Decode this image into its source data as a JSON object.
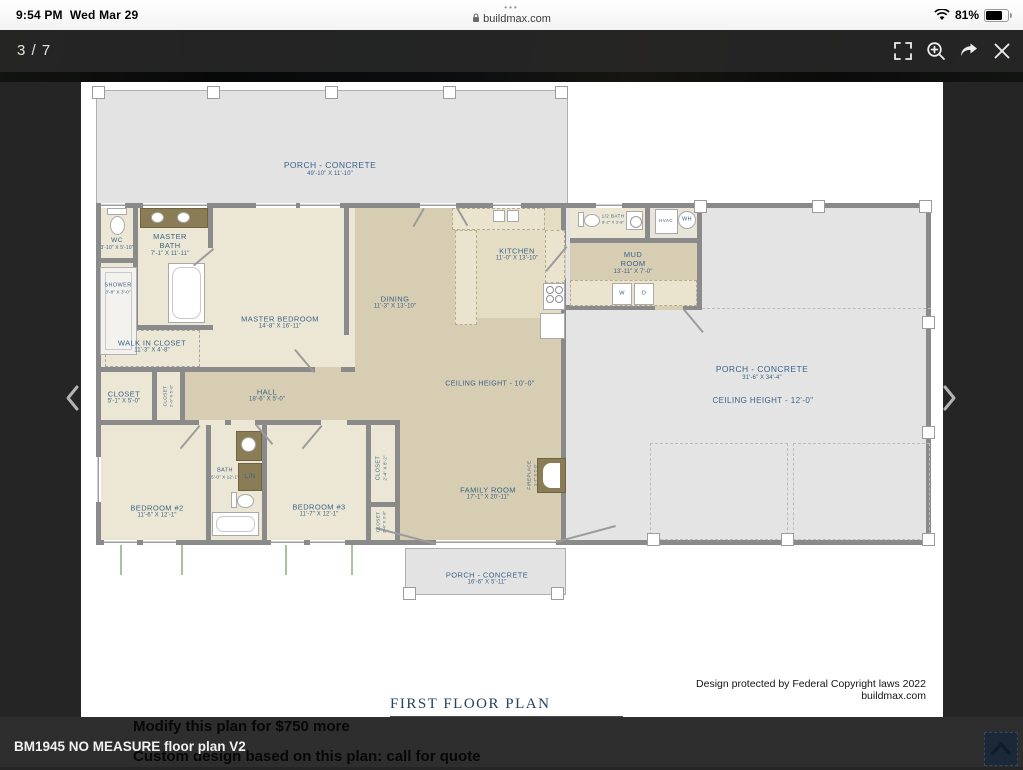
{
  "status_bar": {
    "time": "9:54 PM",
    "date": "Wed Mar 29",
    "tab_dots": "•••",
    "url": "buildmax.com",
    "battery": "81%"
  },
  "toolbar": {
    "page_indicator": "3 / 7"
  },
  "icons": {
    "lock": "padlock",
    "wifi": "wifi-arcs",
    "battery": "battery-80",
    "fullscreen": "⛶",
    "zoom_in": "magnifier-plus",
    "share": "curved-arrow",
    "close": "✕",
    "prev": "‹",
    "next": "›",
    "scroll_top": "chevron-up"
  },
  "plan": {
    "title": "FIRST FLOOR PLAN",
    "copyright": "Design protected by Federal Copyright laws 2022 buildmax.com",
    "colors": {
      "label_ink": "#3a6288",
      "floor_cream": "#ece7d4",
      "floor_khaki": "#d6cdb2",
      "wall": "#8a8a8a",
      "porch": "#e4e4e4",
      "cabinet": "#8a7c54"
    },
    "areas": [
      {
        "name": "PORCH - CONCRETE",
        "dims": "49'-10\" X 11'-10\""
      },
      {
        "name": "WC",
        "dims": "3'-10\" X 5'-10\""
      },
      {
        "name": "MASTER BATH",
        "dims": "7'-1\" X 11'-11\""
      },
      {
        "name": "SHOWER",
        "dims": "3'-8\" X 3'-0\""
      },
      {
        "name": "MASTER BEDROOM",
        "dims": "14'-8\" X 16'-11\""
      },
      {
        "name": "WALK IN CLOSET",
        "dims": "11'-3\" X 4'-8\""
      },
      {
        "name": "CLOSET",
        "dims": "5'-1\" X 5'-0\""
      },
      {
        "name": "CLOSET",
        "dims": "2'-0\" X 5'-0\""
      },
      {
        "name": "HALL",
        "dims": "18'-6\" X 5'-0\""
      },
      {
        "name": "DINING",
        "dims": "11'-3\" X 13'-10\""
      },
      {
        "name": "KITCHEN",
        "dims": "11'-0\" X 13'-10\""
      },
      {
        "name": "MUD ROOM",
        "dims": "13'-11\" X 7'-0\""
      },
      {
        "name": "1/2 BATH",
        "dims": "8'-2\" X 3'-8\""
      },
      {
        "name": "HVAC"
      },
      {
        "name": "WH"
      },
      {
        "name": "W"
      },
      {
        "name": "D"
      },
      {
        "name": "BATH",
        "dims": "5'-0\" X 12'-1\""
      },
      {
        "name": "LIN"
      },
      {
        "name": "BEDROOM #2",
        "dims": "11'-6\" X 12'-1\""
      },
      {
        "name": "BEDROOM #3",
        "dims": "11'-7\" X 12'-1\""
      },
      {
        "name": "CLOSET",
        "dims": "2'-4\" X 8'-2\""
      },
      {
        "name": "CLOSET",
        "dims": "2'-4\" X 3'-8\""
      },
      {
        "name": "FAMILY ROOM",
        "dims": "17'-1\" X 20'-11\""
      },
      {
        "name": "FIREPLACE",
        "dims": "1'-7\" X 5'-0\""
      },
      {
        "name": "CEILING HEIGHT - 10'-0\""
      },
      {
        "name": "PORCH - CONCRETE",
        "dims": "31'-6\" X 34'-4\""
      },
      {
        "name": "CEILING HEIGHT - 12'-0\""
      },
      {
        "name": "PORCH - CONCRETE",
        "dims": "16'-6\" X 5'-11\""
      }
    ]
  },
  "overlay": {
    "modify_line": "Modify this plan for $750 more",
    "filename": "BM1945 NO MEASURE floor plan V2",
    "custom_line": "Custom design based on this plan: call for quote"
  }
}
